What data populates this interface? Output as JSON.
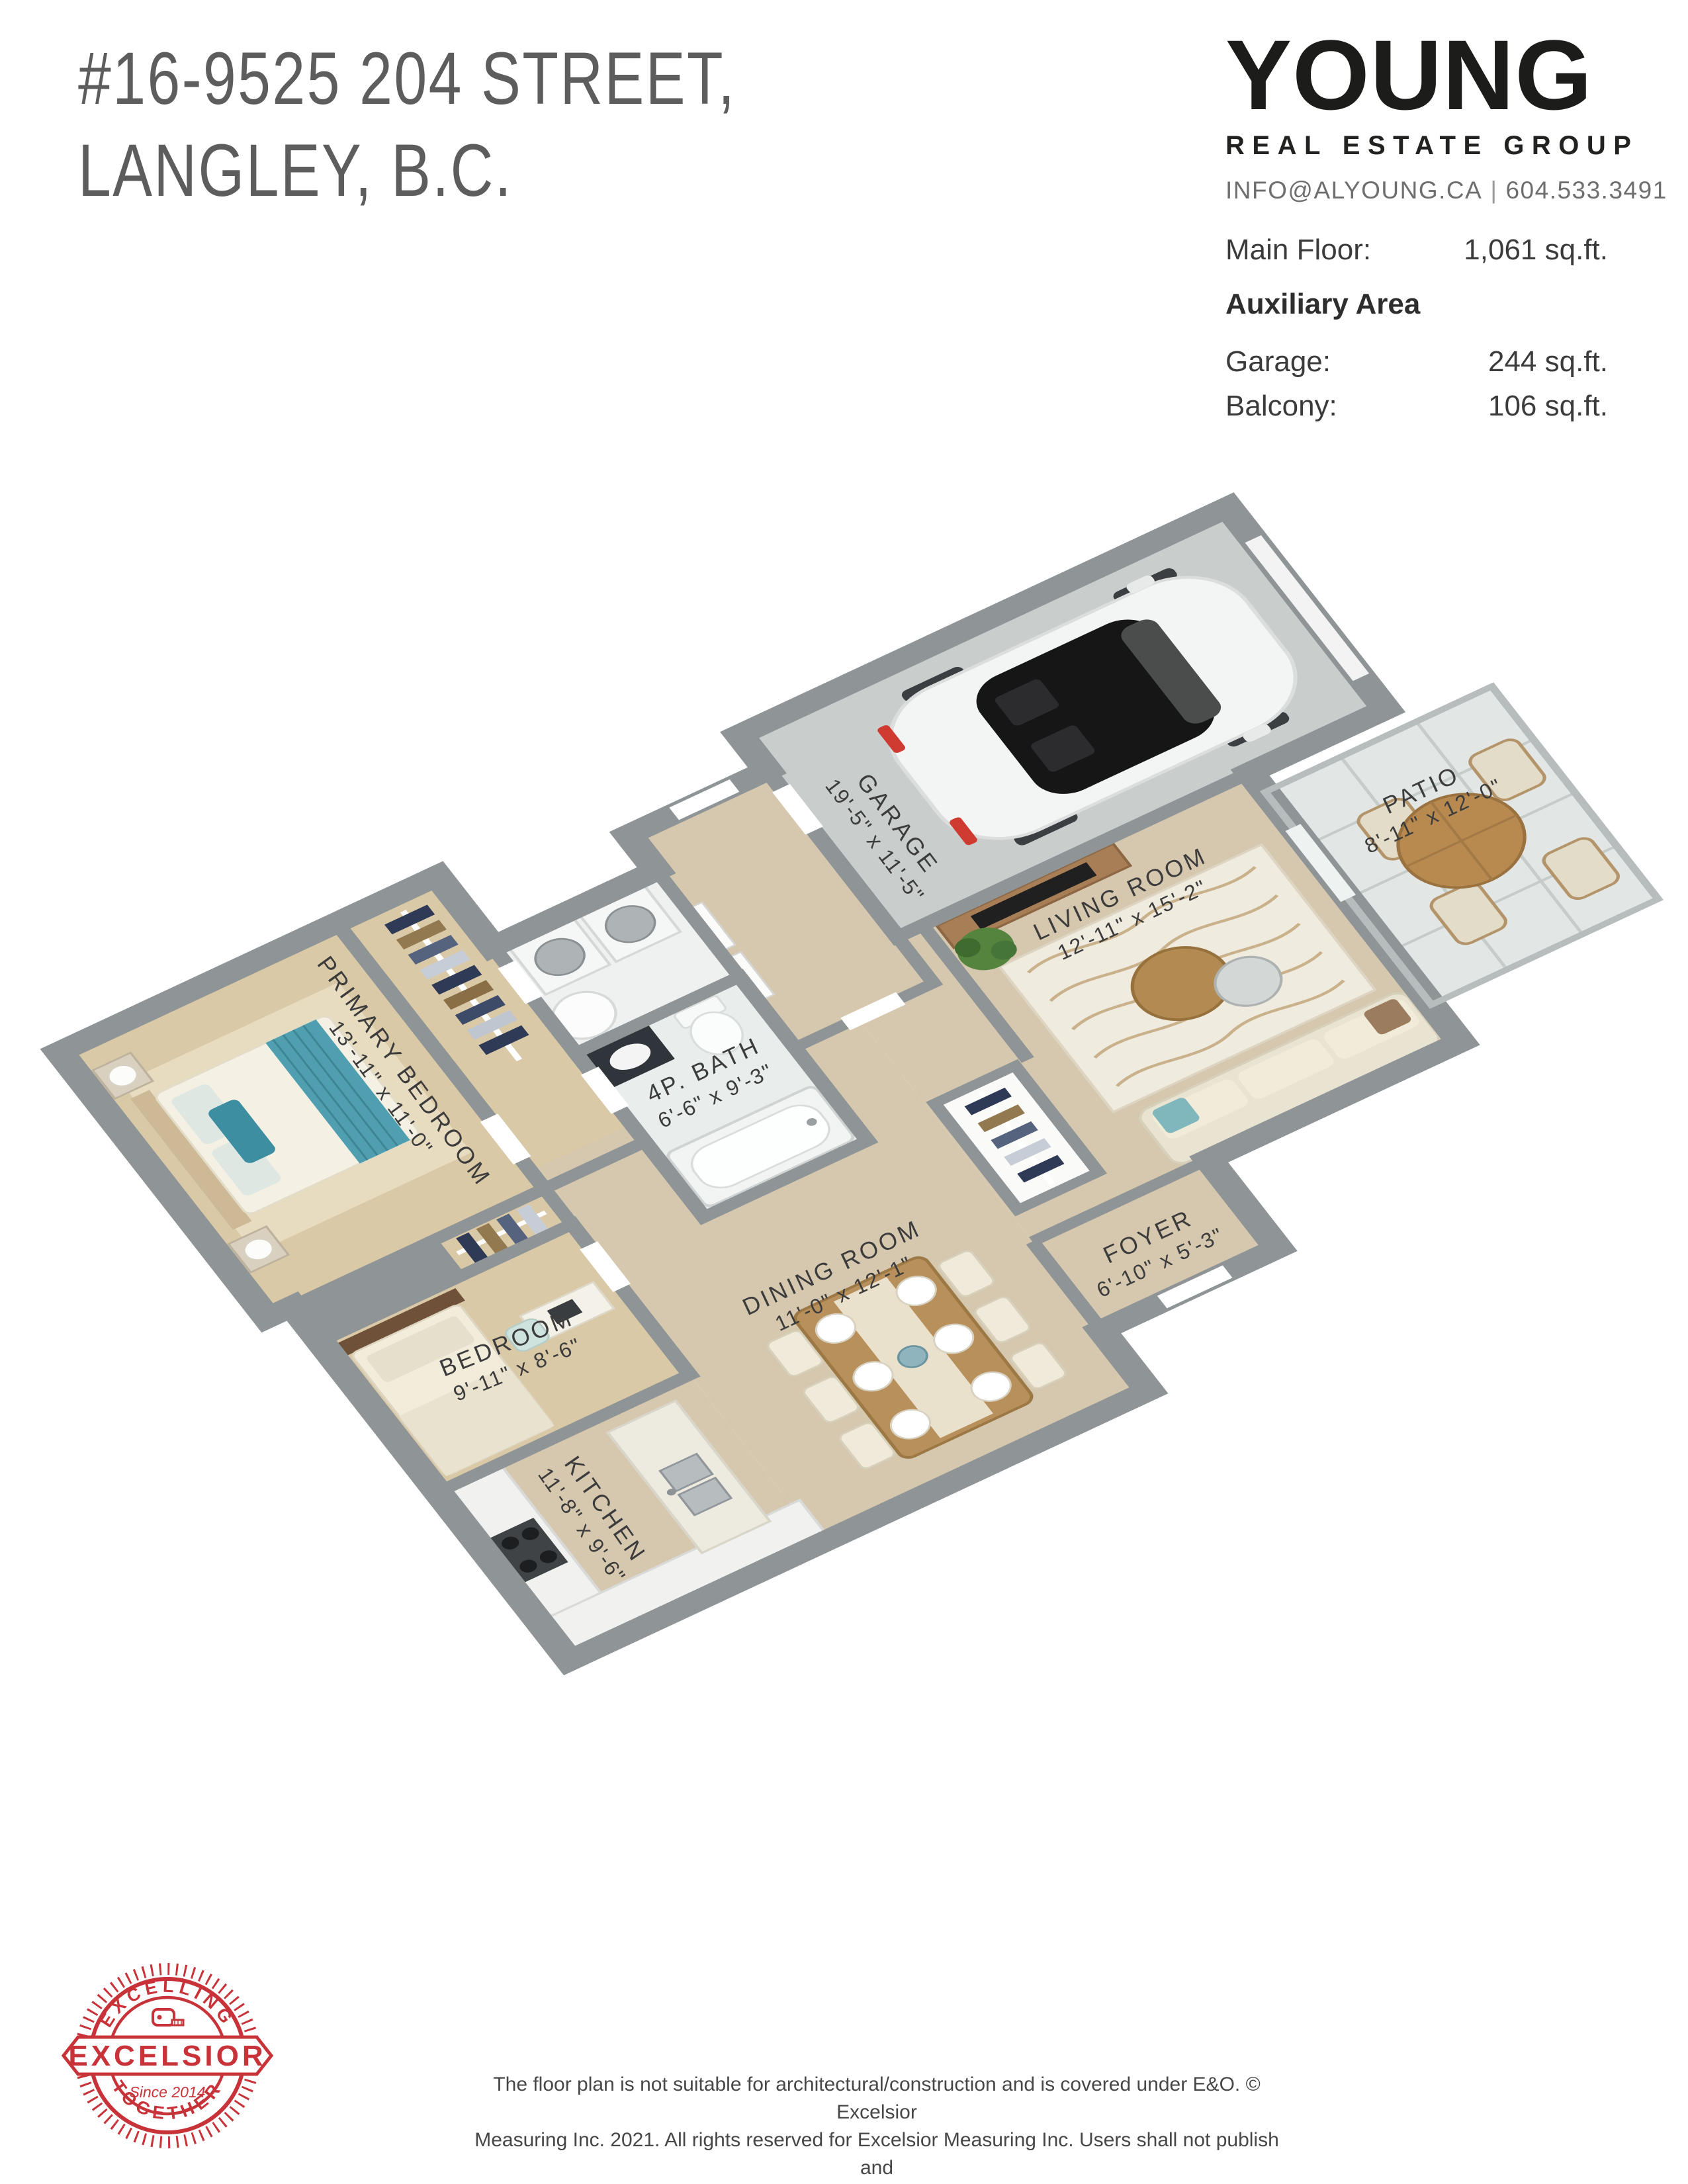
{
  "header": {
    "address_line1": "#16-9525 204 STREET,",
    "address_line2": "LANGLEY, B.C.",
    "brand": {
      "name": "YOUNG",
      "tagline": "REAL ESTATE GROUP",
      "contact_email": "INFO@ALYOUNG.CA",
      "contact_separator": "|",
      "contact_phone": "604.533.3491"
    },
    "areas": {
      "main_floor_label": "Main Floor:",
      "main_floor_value": "1,061 sq.ft.",
      "auxiliary_heading": "Auxiliary Area",
      "rows": [
        {
          "label": "Garage:",
          "value": "244 sq.ft."
        },
        {
          "label": "Balcony:",
          "value": "106 sq.ft."
        }
      ]
    }
  },
  "floorplan": {
    "rooms": [
      {
        "id": "primary_bedroom",
        "label": "PRIMARY BEDROOM",
        "dims": "13'-11\" x 11'-0\""
      },
      {
        "id": "bedroom",
        "label": "BEDROOM",
        "dims": "9'-11\" x 8'-6\""
      },
      {
        "id": "bath",
        "label": "4P. BATH",
        "dims": "6'-6\" x 9'-3\""
      },
      {
        "id": "kitchen",
        "label": "KITCHEN",
        "dims": "11'-8\" x 9'-6\""
      },
      {
        "id": "dining_room",
        "label": "DINING ROOM",
        "dims": "11'-0\" x 12'-1\""
      },
      {
        "id": "foyer",
        "label": "FOYER",
        "dims": "6'-10\" x 5'-3\""
      },
      {
        "id": "living_room",
        "label": "LIVING ROOM",
        "dims": "12'-11\" x 15'-2\""
      },
      {
        "id": "garage",
        "label": "GARAGE",
        "dims": "19'-5\" x 11'-5\""
      },
      {
        "id": "patio",
        "label": "PATIO",
        "dims": "8'-11\" x 12'-0\""
      }
    ]
  },
  "badge": {
    "arc_top_text": "· EXCELLING ·",
    "arc_bottom_text": "· TOGETHER ·",
    "banner_text": "EXCELSIOR",
    "since_text": "- Since 2014 -",
    "color": "#c8333a"
  },
  "footer": {
    "disclaimer_lines": [
      "The floor plan is not suitable for architectural/construction and is covered under E&O. © Excelsior",
      "Measuring Inc. 2021. All rights reserved for Excelsior Measuring Inc. Users shall not publish and",
      "distribute such material (in whole or in part) and/or incorporate it in other works in any form."
    ]
  },
  "palette": {
    "wall_gray": "#8f9496",
    "carpet": "#dac9a7",
    "wood": "#d6c8af",
    "garage_concrete": "#c9cdcc",
    "bath_tile": "#e9edeb",
    "patio_tile": "#e2e6e5",
    "accent_teal": "#3d8ea0",
    "badge_red": "#c8333a"
  }
}
